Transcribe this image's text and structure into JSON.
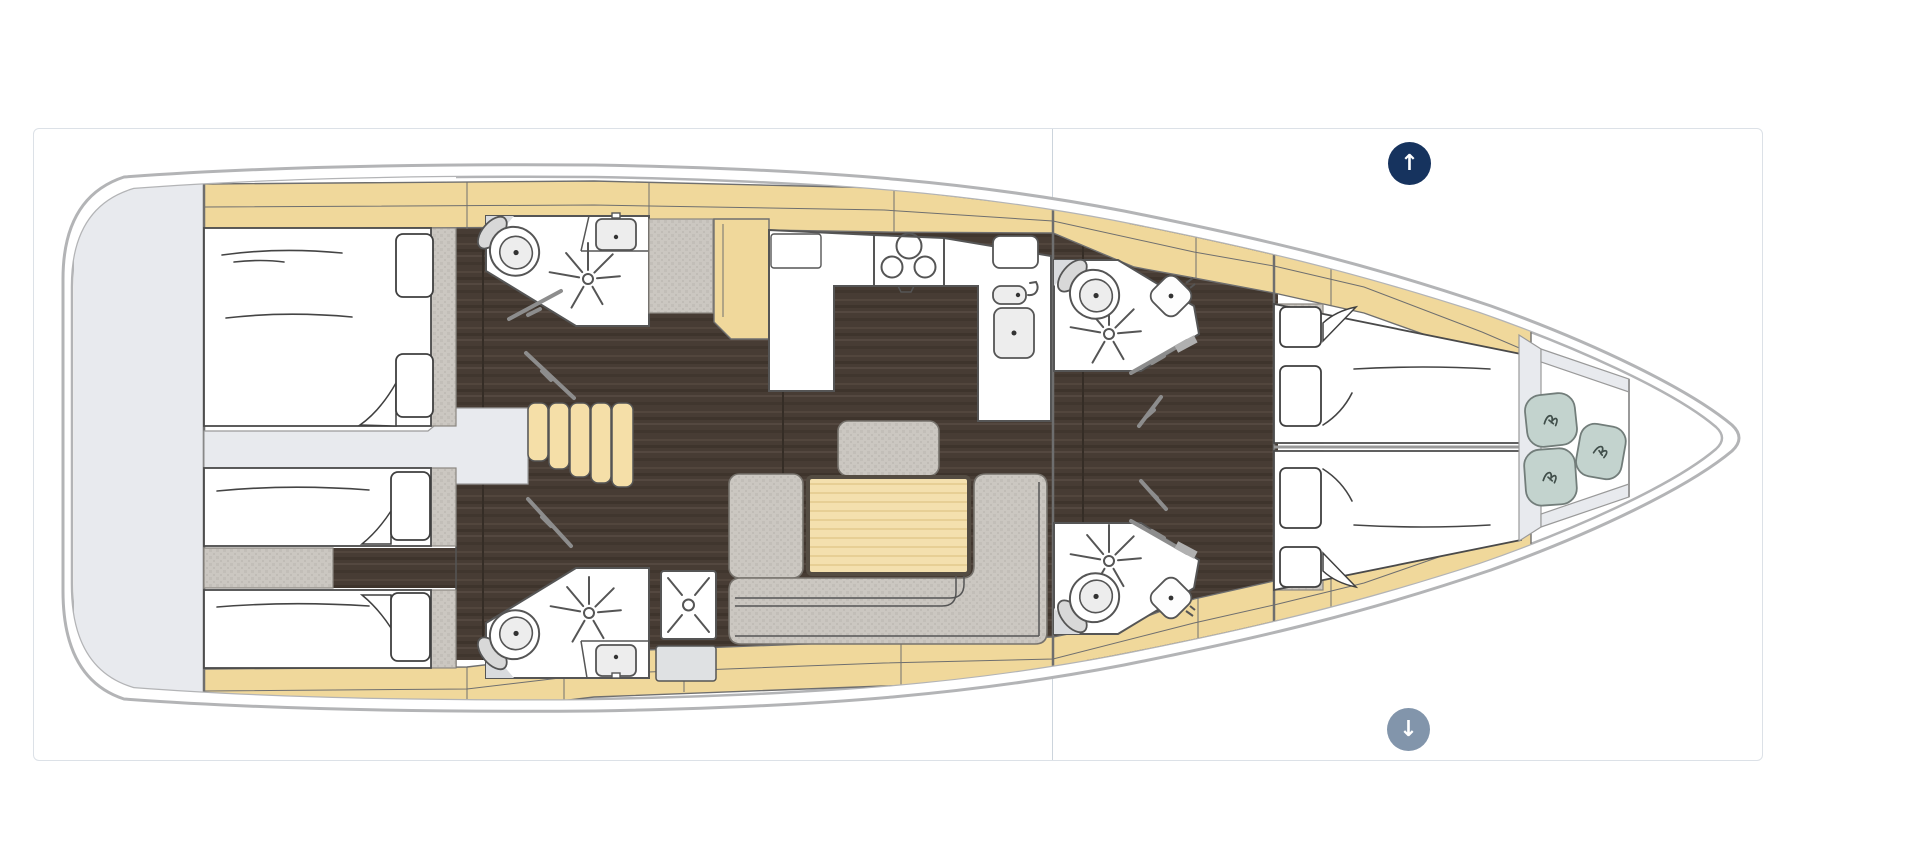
{
  "window": {
    "background": "#ffffff"
  },
  "panel": {
    "background": "#ffffff",
    "border_color": "#dce1e7",
    "divider_color": "#ccd4dc"
  },
  "controls": {
    "scroll_up_button": {
      "icon": "arrow-up-icon",
      "glyph": "↑",
      "background": "#16335e",
      "color": "#ffffff"
    },
    "scroll_down_button": {
      "icon": "arrow-down-icon",
      "glyph": "↓",
      "background": "#8295ab",
      "color": "#ffffff"
    }
  },
  "floorplan": {
    "type": "sailing-yacht-deck-plan",
    "orientation": "bow-right",
    "colors": {
      "page_bg": "#ffffff",
      "panel_bg": "#ffffff",
      "panel_border": "#dce1e7",
      "divider": "#ccd4dc",
      "hull_outline": "#b3b4b6",
      "deck_wood": "#f0d89b",
      "stair_wood": "#f5dfa8",
      "table_wood": "#f4e0ae",
      "floor_dark": "#473c34",
      "furniture_gray": "#cbc7c1",
      "panel_gray": "#e8eaee",
      "cushion_sage": "#c3d3ce",
      "wall_gray": "#6e6e6e"
    },
    "rooms": [
      {
        "name": "transom-platform"
      },
      {
        "name": "aft-cabin-upper",
        "berths": "double"
      },
      {
        "name": "aft-cabin-lower",
        "berths": "twin"
      },
      {
        "name": "aft-head-upper",
        "fixtures": [
          "toilet",
          "sink",
          "shower-spray"
        ]
      },
      {
        "name": "aft-head-lower",
        "fixtures": [
          "toilet",
          "sink",
          "shower-spray",
          "shower-stall"
        ]
      },
      {
        "name": "companionway-stairs"
      },
      {
        "name": "galley",
        "fixtures": [
          "stove-3-burner",
          "fridge",
          "double-sink",
          "faucet"
        ]
      },
      {
        "name": "salon",
        "furniture": [
          "u-sofa",
          "table"
        ]
      },
      {
        "name": "fwd-head-upper",
        "fixtures": [
          "toilet",
          "sink",
          "shower-spray"
        ]
      },
      {
        "name": "fwd-head-lower",
        "fixtures": [
          "toilet",
          "sink",
          "shower-spray"
        ]
      },
      {
        "name": "fwd-cabin",
        "berths": "v-berth-double"
      },
      {
        "name": "bow-seating",
        "seats": 3
      }
    ]
  }
}
